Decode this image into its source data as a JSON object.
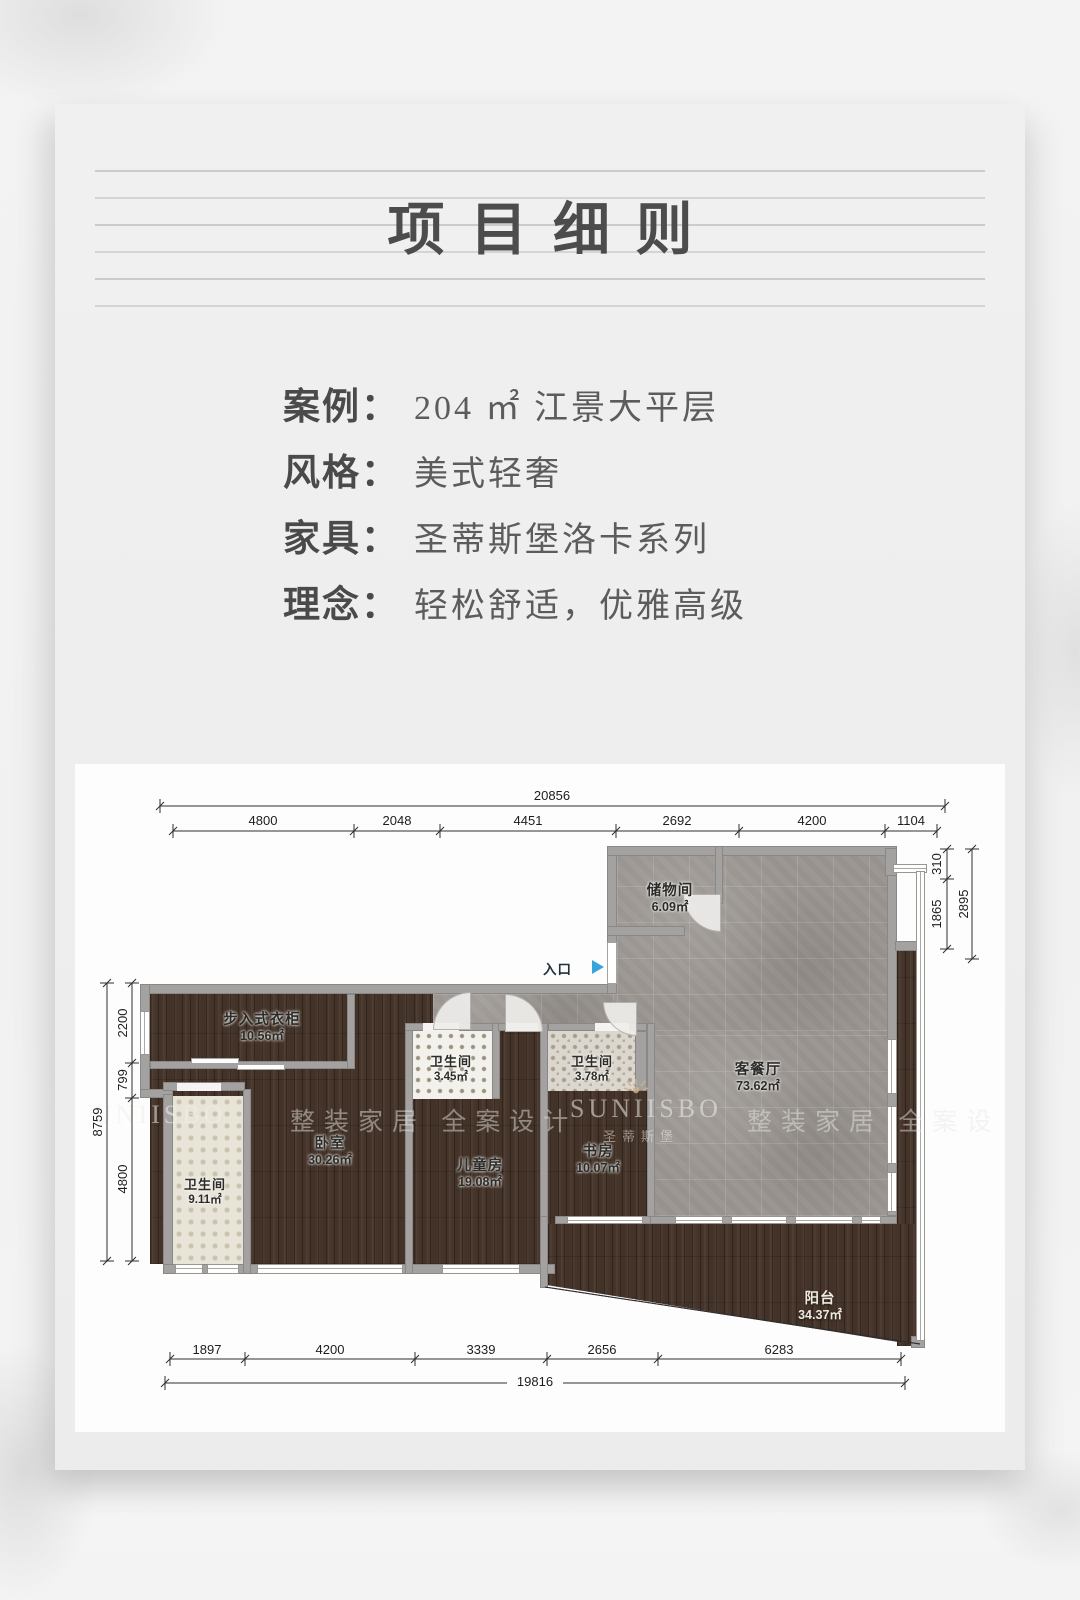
{
  "page": {
    "title": "项目细则"
  },
  "info": {
    "rows": [
      {
        "label": "案例：",
        "value": "204 ㎡ 江景大平层"
      },
      {
        "label": "风格：",
        "value": "美式轻奢"
      },
      {
        "label": "家具：",
        "value": "圣蒂斯堡洛卡系列"
      },
      {
        "label": "理念：",
        "value": "轻松舒适，优雅高级"
      }
    ]
  },
  "floorplan": {
    "entry_label": "入口",
    "entry_arrow_color": "#38a4dc",
    "rooms": [
      {
        "name": "储物间",
        "area": "6.09㎡"
      },
      {
        "name": "步入式衣柜",
        "area": "10.56㎡"
      },
      {
        "name": "卫生间",
        "area": "3.45㎡"
      },
      {
        "name": "卫生间",
        "area": "3.78㎡"
      },
      {
        "name": "客餐厅",
        "area": "73.62㎡"
      },
      {
        "name": "卧室",
        "area": "30.26㎡"
      },
      {
        "name": "儿童房",
        "area": "19.08㎡"
      },
      {
        "name": "书房",
        "area": "10.07㎡"
      },
      {
        "name": "卫生间",
        "area": "9.11㎡"
      },
      {
        "name": "阳台",
        "area": "34.37㎡"
      }
    ],
    "dimensions": {
      "top_total": "20856",
      "top_segments": [
        "4800",
        "2048",
        "4451",
        "2692",
        "4200",
        "1104"
      ],
      "right_segments": [
        "310",
        "1865"
      ],
      "right_total": "2895",
      "left_total": "8759",
      "left_segments": [
        "2200",
        "799",
        "4800"
      ],
      "bottom_segments": [
        "1897",
        "4200",
        "3339",
        "2656",
        "6283"
      ],
      "bottom_total": "19816"
    },
    "watermarks": {
      "brand": "SUNIISBO",
      "brand_cn": "圣蒂斯堡",
      "brand_partial": "UNIISBO",
      "slogan_left": "整装家居 全案设计",
      "slogan_right": "整装家居 全案设"
    }
  }
}
